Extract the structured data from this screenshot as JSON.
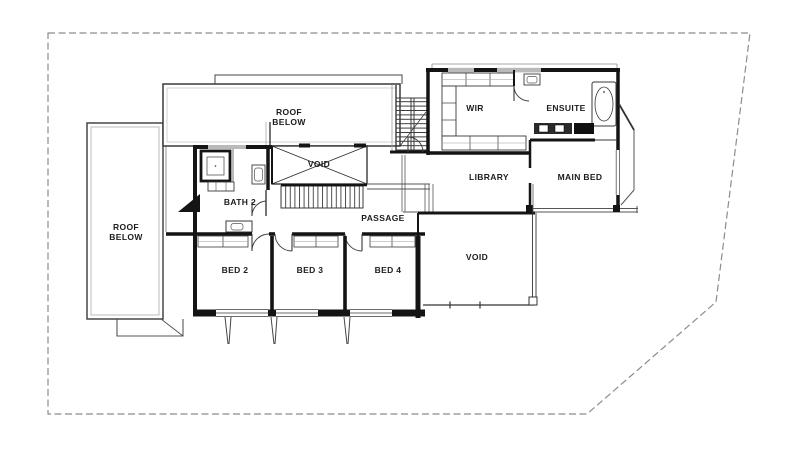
{
  "plan": {
    "labels": {
      "roof_below_top": "ROOF\nBELOW",
      "roof_below_left": "ROOF\nBELOW",
      "void_upper": "VOID",
      "bath_2": "BATH 2",
      "passage": "PASSAGE",
      "bed_2": "BED 2",
      "bed_3": "BED 3",
      "bed_4": "BED 4",
      "void_main": "VOID",
      "wir": "WIR",
      "ensuite": "ENSUITE",
      "library": "LIBRARY",
      "main_bed": "MAIN BED"
    }
  },
  "colors": {
    "wall": "#141414",
    "line": "#3a3a3a",
    "light_line": "#9e9e9e",
    "boundary": "#8c8c8c",
    "background": "#ffffff",
    "text": "#1c1c1c"
  }
}
